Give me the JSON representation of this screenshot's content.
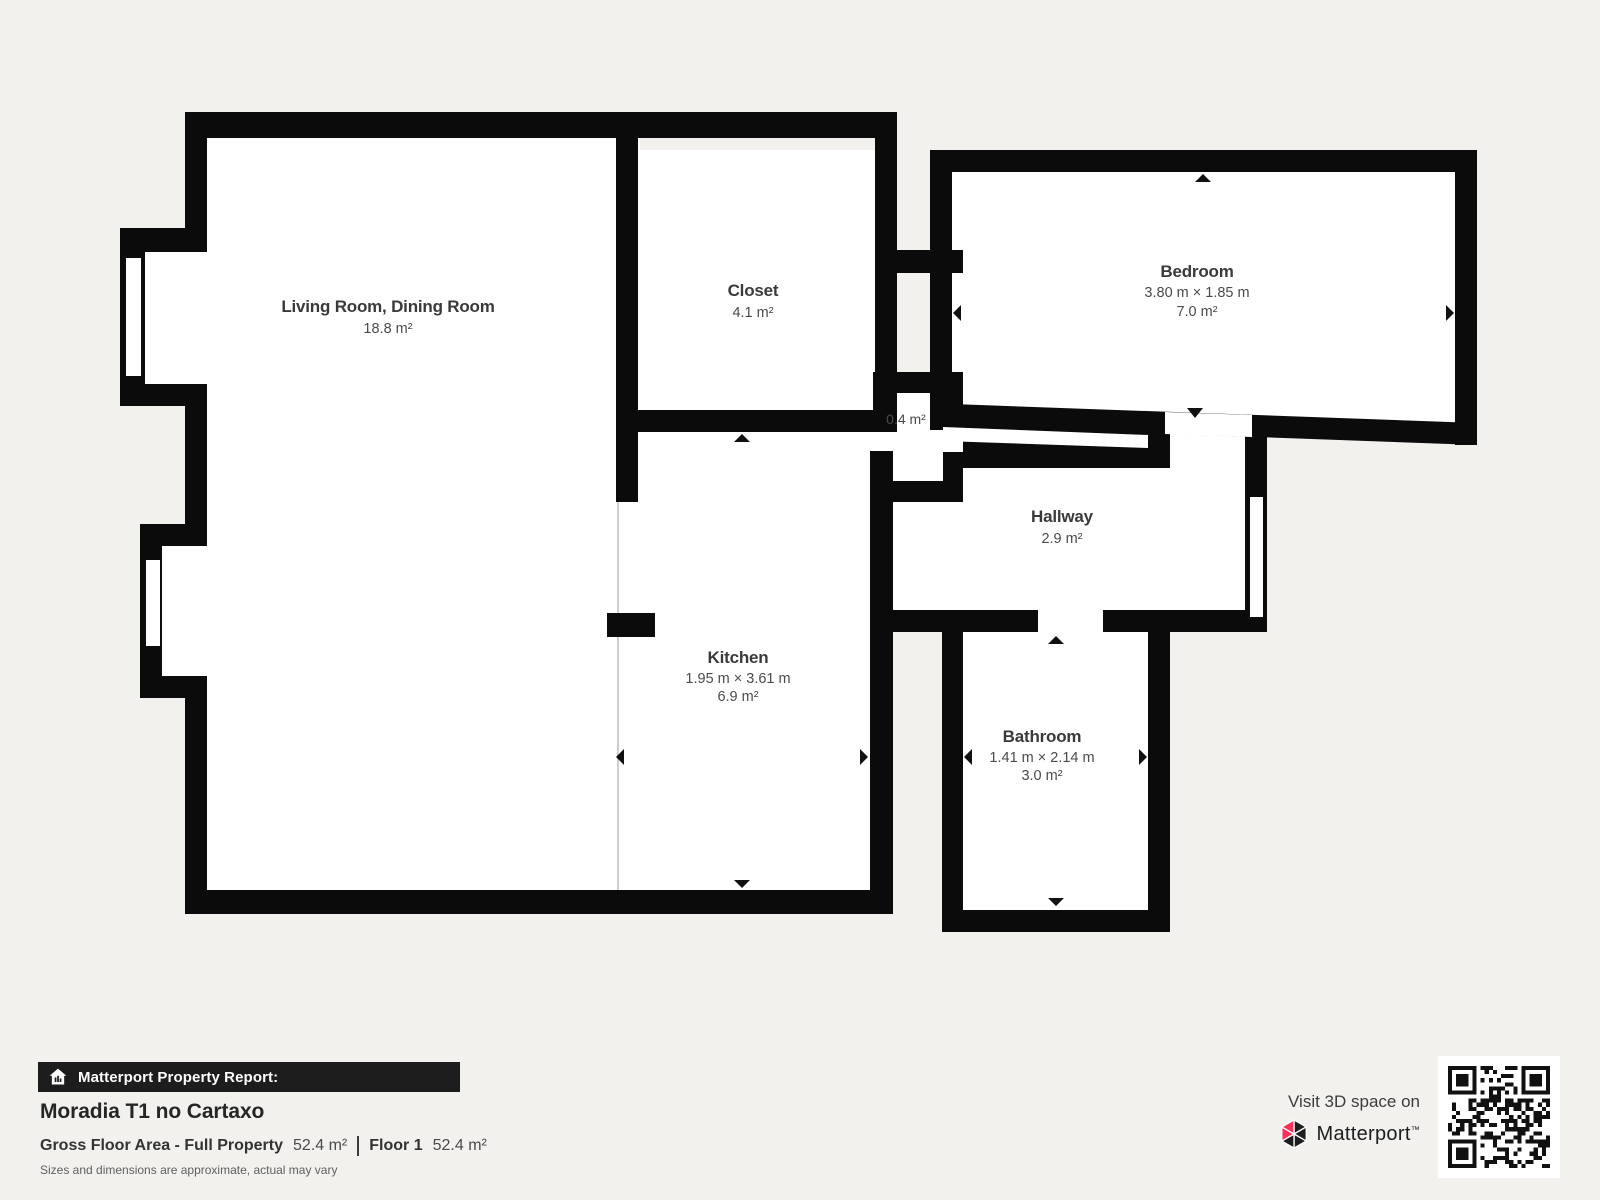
{
  "floorplan": {
    "rooms": [
      {
        "id": "living",
        "name": "Living Room, Dining Room",
        "area": "18.8 m²"
      },
      {
        "id": "closet",
        "name": "Closet",
        "area": "4.1 m²"
      },
      {
        "id": "bedroom",
        "name": "Bedroom",
        "dimensions": "3.80 m × 1.85 m",
        "area": "7.0 m²"
      },
      {
        "id": "niche",
        "area": "0.4 m²"
      },
      {
        "id": "hallway",
        "name": "Hallway",
        "area": "2.9 m²"
      },
      {
        "id": "kitchen",
        "name": "Kitchen",
        "dimensions": "1.95 m × 3.61 m",
        "area": "6.9 m²"
      },
      {
        "id": "bathroom",
        "name": "Bathroom",
        "dimensions": "1.41 m × 2.14 m",
        "area": "3.0 m²"
      }
    ],
    "colors": {
      "wall": "#0b0b0b",
      "room_fill": "#ffffff",
      "background": "#f2f1ee",
      "open_boundary_line": "#cfcfcf"
    }
  },
  "report": {
    "badge": "Matterport Property Report:",
    "title": "Moradia T1 no Cartaxo",
    "gross_label": "Gross Floor Area - Full Property",
    "gross_value": "52.4 m²",
    "floor_label": "Floor 1",
    "floor_value": "52.4 m²",
    "disclaimer": "Sizes and dimensions are approximate, actual may vary"
  },
  "promo": {
    "visit": "Visit 3D space on",
    "brand": "Matterport",
    "tm": "™",
    "brand_red": "#ff3158",
    "brand_ink": "#1d1d1f"
  }
}
